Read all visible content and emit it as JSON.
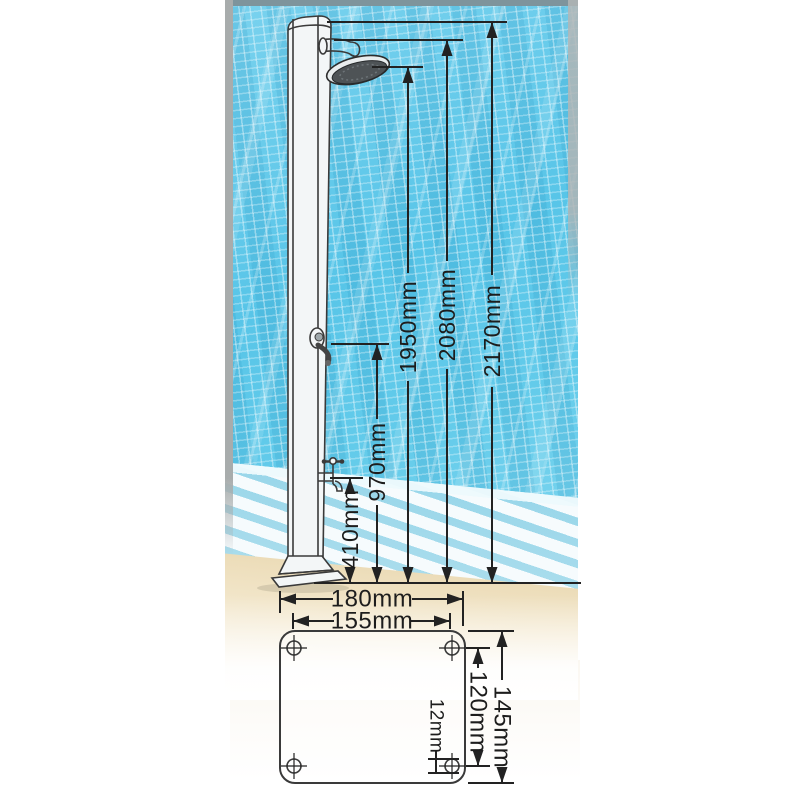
{
  "colors": {
    "pool-blue": "#5cc6e8",
    "pool-blue-deep": "#45b9e0",
    "pool-grout": "#aee4f5",
    "deck-sand": "#eedfbe",
    "grate-white": "#f6fbfd",
    "line-color": "#222222",
    "label-color": "#1d1d1d",
    "photo-border-gray": "#a8acac"
  },
  "shower_diagram": {
    "height_dimensions": [
      {
        "id": "410",
        "label": "410mm",
        "value_mm": 410
      },
      {
        "id": "970",
        "label": "970mm",
        "value_mm": 970
      },
      {
        "id": "1950",
        "label": "1950mm",
        "value_mm": 1950
      },
      {
        "id": "2080",
        "label": "2080mm",
        "value_mm": 2080
      },
      {
        "id": "2170",
        "label": "2170mm",
        "value_mm": 2170
      }
    ]
  },
  "base_plate_diagram": {
    "width_dimensions": [
      {
        "id": "180",
        "label": "180mm",
        "value_mm": 180
      },
      {
        "id": "155",
        "label": "155mm",
        "value_mm": 155
      }
    ],
    "height_dimensions": [
      {
        "id": "145",
        "label": "145mm",
        "value_mm": 145
      },
      {
        "id": "120",
        "label": "120mm",
        "value_mm": 120
      },
      {
        "id": "12",
        "label": "12mm",
        "value_mm": 12
      }
    ]
  }
}
